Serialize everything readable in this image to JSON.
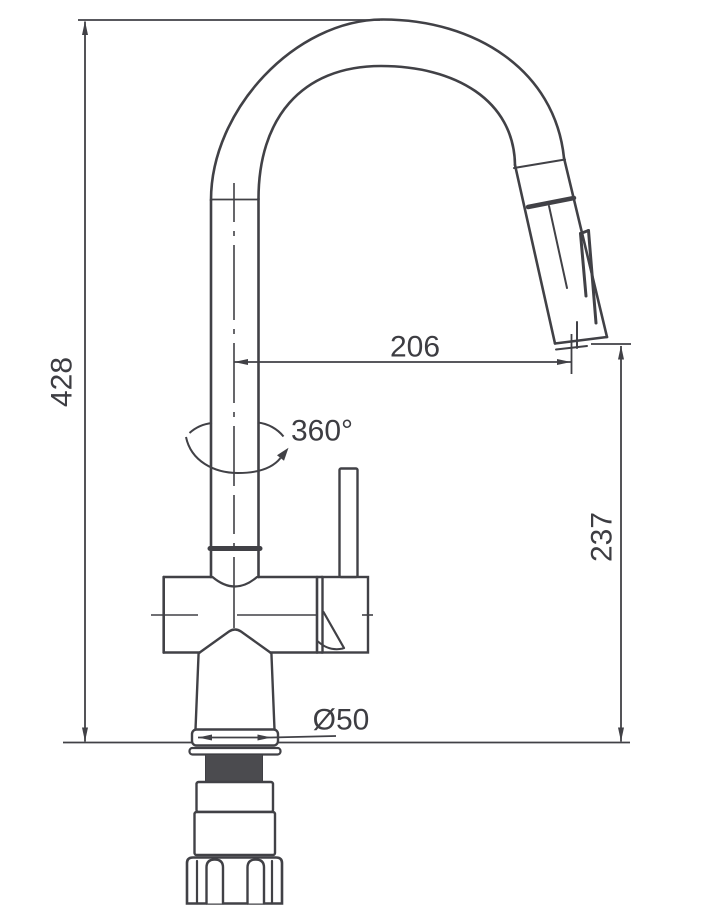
{
  "title": "Pull-down kitchen faucet dimensional drawing",
  "colors": {
    "line": "#414146",
    "text": "#3d3d42",
    "thread_fill": "#4b4b4f",
    "background": "#ffffff"
  },
  "dimensions": {
    "overall_height": "428",
    "spout_reach": "206",
    "outlet_height": "237",
    "swivel_angle": "360°",
    "base_diameter": "Ø50"
  }
}
